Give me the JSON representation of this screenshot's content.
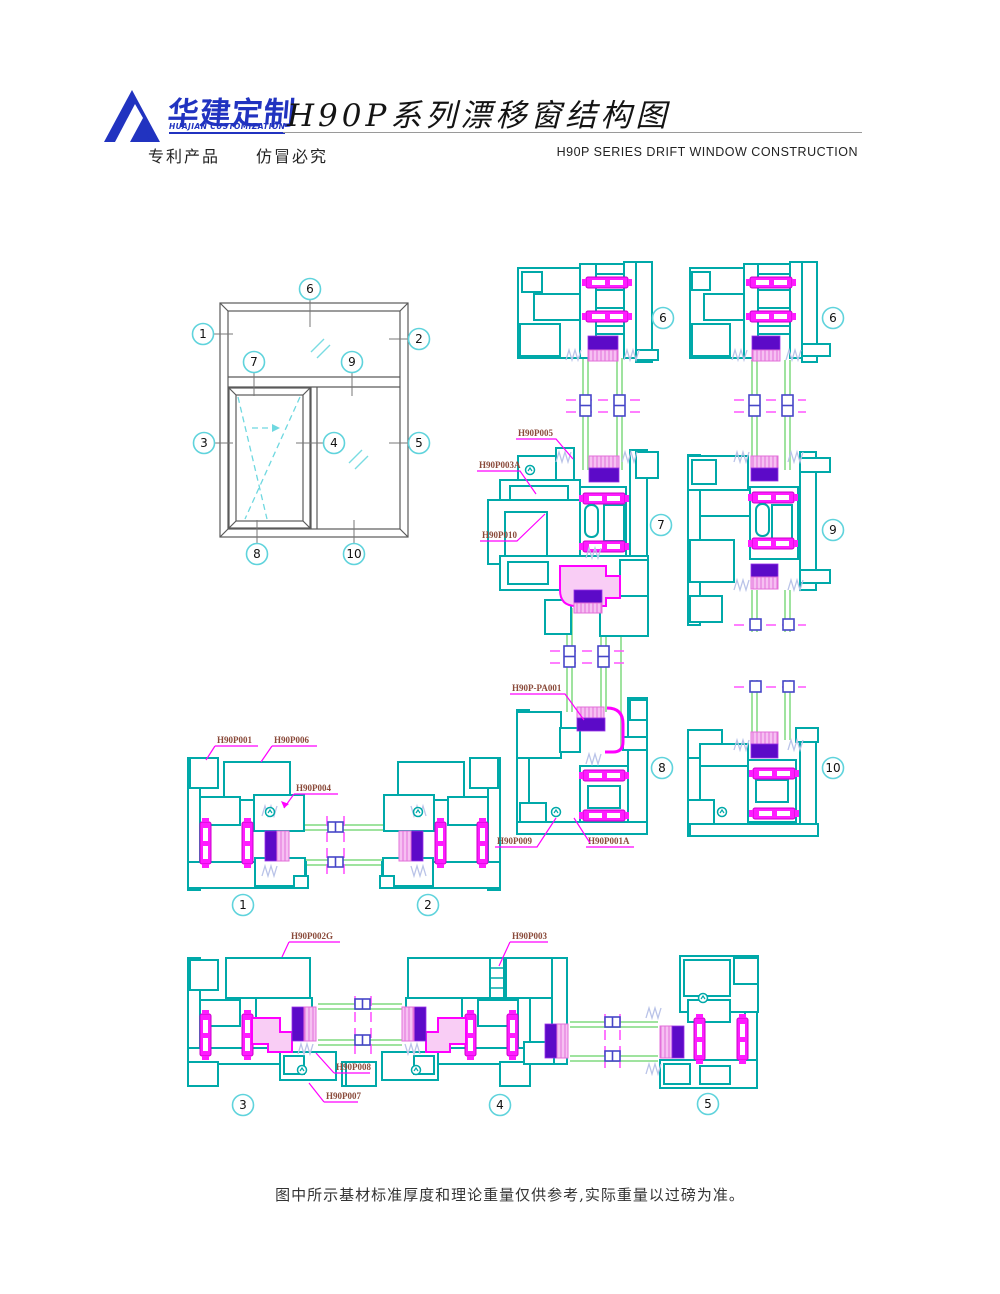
{
  "header": {
    "brand_cn": "华建定制",
    "brand_en": "HUAJIAN CUSTOMIZATION",
    "title_cn": "H90P系列漂移窗结构图",
    "patent_note": "专利产品　　仿冒必究",
    "title_en": "H90P  SERIES  DRIFT   WINDOW CONSTRUCTION"
  },
  "elevation": {
    "callouts": [
      "1",
      "2",
      "3",
      "4",
      "5",
      "6",
      "7",
      "8",
      "9",
      "10"
    ]
  },
  "sections": {
    "mid_top": {
      "callout": "6"
    },
    "mid_center": {
      "callout": "7"
    },
    "mid_bottom": {
      "callout": "8"
    },
    "right_top": {
      "callout": "6"
    },
    "right_center": {
      "callout": "9"
    },
    "right_bottom": {
      "callout": "10"
    },
    "row1_left": {
      "callout": "1"
    },
    "row1_right": {
      "callout": "2"
    },
    "row2_left": {
      "callout": "3"
    },
    "row2_center": {
      "callout": "4"
    },
    "row2_right": {
      "callout": "5"
    }
  },
  "part_labels": {
    "h90p005": "H90P005",
    "h90p003a": "H90P003A",
    "h90p010": "H90P010",
    "h90p_pa001": "H90P-PA001",
    "h90p009": "H90P009",
    "h90p001a": "H90P001A",
    "h90p001": "H90P001",
    "h90p006": "H90P006",
    "h90p004": "H90P004",
    "h90p002g": "H90P002G",
    "h90p003": "H90P003",
    "h90p008": "H90P008",
    "h90p007": "H90P007"
  },
  "footer": {
    "note": "图中所示基材标准厚度和理论重量仅供参考,实际重量以过磅为准。"
  },
  "colors": {
    "logo_blue": "#2133c0",
    "profile_teal": "#00a9a9",
    "gasket_magenta": "#ff00ff",
    "glazing_purple": "#5c0ac8",
    "glazing_pink": "#f6c0f2",
    "glass_green": "#9fe39f",
    "spacer_blue": "#4646c8",
    "callout_cyan": "#5fd3dc",
    "label_red": "#8a4a3a"
  }
}
